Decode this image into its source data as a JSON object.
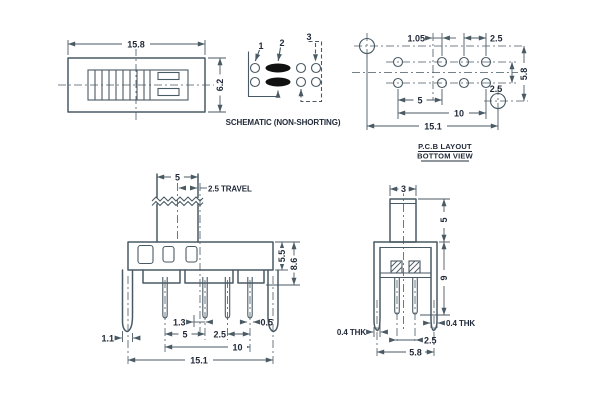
{
  "colors": {
    "line": "#4a5a64",
    "text": "#232b3a",
    "contact_fill": "#111111",
    "background": "#ffffff"
  },
  "top_view": {
    "width": "15.8",
    "height": "6.2"
  },
  "schematic": {
    "pin1": "1",
    "pin2": "2",
    "pin3": "3",
    "caption": "SCHEMATIC (NON-SHORTING)"
  },
  "pcb_layout": {
    "title_line1": "P.C.B LAYOUT",
    "title_line2": "BOTTOM VIEW",
    "center_offset": "1.05",
    "pitch_right": "2.5",
    "row_gap": "2.5",
    "hole_height": "5.8",
    "pitch_5": "5",
    "pitch_10": "10",
    "overall_width": "15.1"
  },
  "front_view": {
    "knob_width": "5",
    "travel": "2.5 TRAVEL",
    "upper_body_height": "5.5",
    "body_height": "8.6",
    "leg_width": "1.1",
    "pin_offset": "1.3",
    "pin_width": "0.5",
    "pitch_5": "5",
    "pitch_2_5": "2.5",
    "pitch_10": "10",
    "overall_width": "15.1"
  },
  "side_view": {
    "knob_width": "3",
    "knob_height": "5",
    "body_height": "9",
    "thk_left": "0.4 THK",
    "thk_right": "0.4 THK",
    "pin_pitch": "2.5",
    "overall_width": "5.8"
  }
}
